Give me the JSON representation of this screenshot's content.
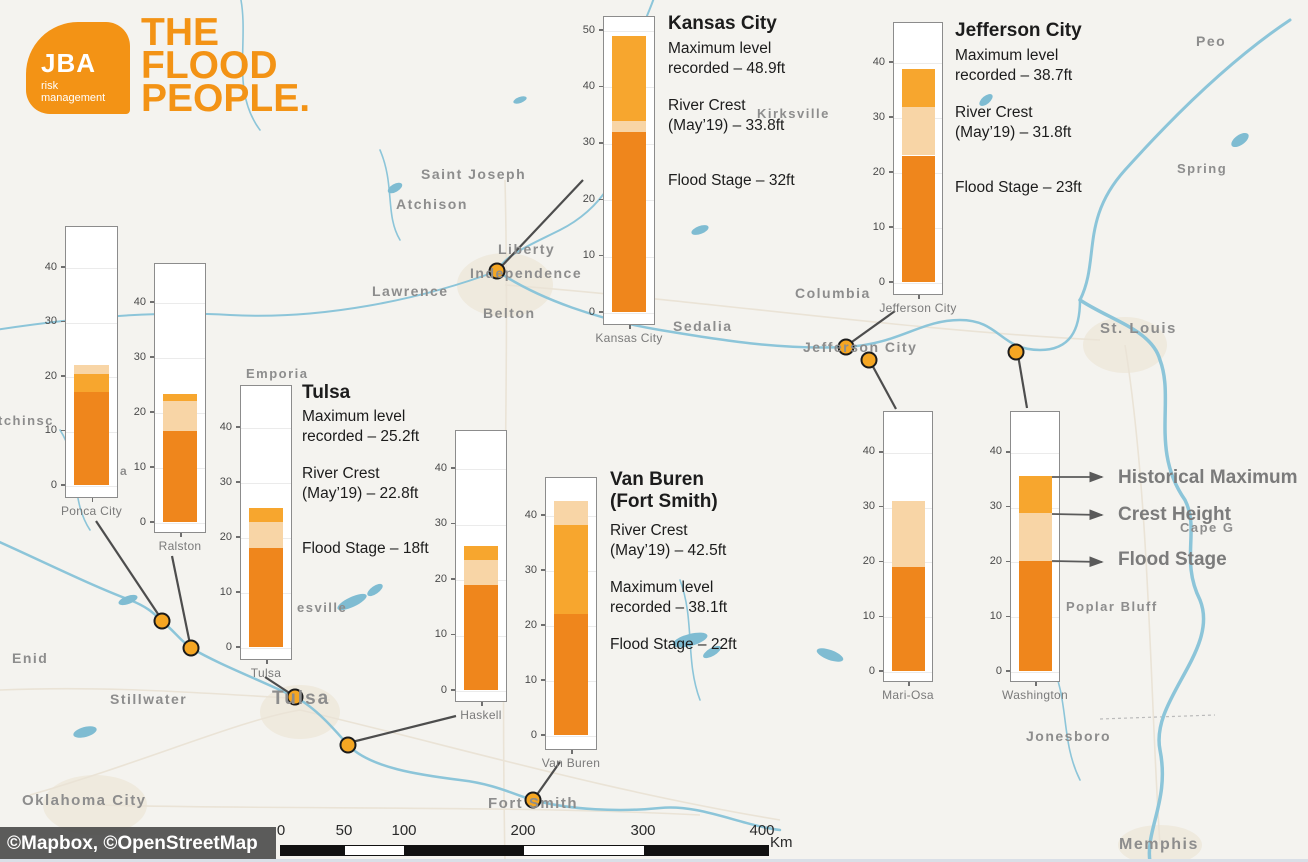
{
  "brand": {
    "logo_text": "JBA",
    "logo_sub_line1": "risk",
    "logo_sub_line2": "management",
    "tagline_line1": "THE",
    "tagline_line2": "FLOOD",
    "tagline_line3": "PEOPLE.",
    "orange": "#f39315"
  },
  "colors": {
    "flood_stage": "#ef861c",
    "crest": "#f8d5a6",
    "historical_maximum": "#f7a62e",
    "marker": "#f5a623",
    "map_label": "#8d8d8d",
    "legend_text": "#7b7b7b",
    "connector": "#4d4d4d",
    "water": "#8cc5d9"
  },
  "chart_data": [
    {
      "id": "kansas-city-gauge",
      "type": "bar",
      "gauge_label": "Kansas City",
      "yticks": [
        0,
        10,
        20,
        30,
        40,
        50
      ],
      "ylim": [
        0,
        52.5
      ],
      "values": {
        "flood_stage_ft": 32,
        "crest_may19_ft": 33.8,
        "historical_max_ft": 48.9
      },
      "segments": [
        {
          "role": "flood_stage",
          "from": 0,
          "to": 32
        },
        {
          "role": "crest",
          "from": 32,
          "to": 33.8
        },
        {
          "role": "historical_maximum",
          "from": 33.8,
          "to": 48.9
        }
      ]
    },
    {
      "id": "jefferson-city-gauge",
      "type": "bar",
      "gauge_label": "Jefferson City",
      "yticks": [
        0,
        10,
        20,
        30,
        40
      ],
      "ylim": [
        0,
        47.5
      ],
      "values": {
        "flood_stage_ft": 23,
        "crest_may19_ft": 31.8,
        "historical_max_ft": 38.7
      },
      "segments": [
        {
          "role": "flood_stage",
          "from": 0,
          "to": 23
        },
        {
          "role": "crest",
          "from": 23,
          "to": 31.8
        },
        {
          "role": "historical_maximum",
          "from": 31.8,
          "to": 38.7
        }
      ]
    },
    {
      "id": "ponca-city",
      "type": "bar",
      "gauge_label": "Ponca City",
      "yticks": [
        0,
        10,
        20,
        30,
        40
      ],
      "ylim": [
        0,
        47.5
      ],
      "values": {
        "flood_stage_ft": 17,
        "historical_max_ft": 20.3,
        "crest_may19_ft": 22
      },
      "segments": [
        {
          "role": "flood_stage",
          "from": 0,
          "to": 17
        },
        {
          "role": "historical_maximum",
          "from": 17,
          "to": 20.3
        },
        {
          "role": "crest",
          "from": 20.3,
          "to": 22
        }
      ]
    },
    {
      "id": "ralston",
      "type": "bar",
      "gauge_label": "Ralston",
      "yticks": [
        0,
        10,
        20,
        30,
        40
      ],
      "ylim": [
        0,
        47.5
      ],
      "values": {
        "flood_stage_ft": 16.5,
        "crest_may19_ft": 22,
        "historical_max_ft": 23.3
      },
      "segments": [
        {
          "role": "flood_stage",
          "from": 0,
          "to": 16.5
        },
        {
          "role": "crest",
          "from": 16.5,
          "to": 22
        },
        {
          "role": "historical_maximum",
          "from": 22,
          "to": 23.3
        }
      ]
    },
    {
      "id": "tulsa-gauge",
      "type": "bar",
      "gauge_label": "Tulsa",
      "yticks": [
        0,
        10,
        20,
        30,
        40
      ],
      "ylim": [
        0,
        47.5
      ],
      "values": {
        "flood_stage_ft": 18,
        "crest_may19_ft": 22.8,
        "historical_max_ft": 25.2
      },
      "segments": [
        {
          "role": "flood_stage",
          "from": 0,
          "to": 18
        },
        {
          "role": "crest",
          "from": 18,
          "to": 22.8
        },
        {
          "role": "historical_maximum",
          "from": 22.8,
          "to": 25.2
        }
      ]
    },
    {
      "id": "haskell",
      "type": "bar",
      "gauge_label": "Haskell",
      "yticks": [
        0,
        10,
        20,
        30,
        40
      ],
      "ylim": [
        0,
        47.5
      ],
      "values": {
        "flood_stage_ft": 19,
        "crest_may19_ft": 23.5,
        "historical_max_ft": 26
      },
      "segments": [
        {
          "role": "flood_stage",
          "from": 0,
          "to": 19
        },
        {
          "role": "crest",
          "from": 19,
          "to": 23.5
        },
        {
          "role": "historical_maximum",
          "from": 23.5,
          "to": 26
        }
      ]
    },
    {
      "id": "van-buren",
      "type": "bar",
      "gauge_label": "Van Buren",
      "yticks": [
        0,
        10,
        20,
        30,
        40
      ],
      "ylim": [
        0,
        46.9
      ],
      "values": {
        "flood_stage_ft": 22,
        "historical_max_ft": 38.1,
        "crest_may19_ft": 42.5
      },
      "segments": [
        {
          "role": "flood_stage",
          "from": 0,
          "to": 22
        },
        {
          "role": "historical_maximum",
          "from": 22,
          "to": 38.1
        },
        {
          "role": "crest",
          "from": 38.1,
          "to": 42.5
        }
      ]
    },
    {
      "id": "mari-osa",
      "type": "bar",
      "gauge_label": "Mari-Osa",
      "yticks": [
        0,
        10,
        20,
        30,
        40
      ],
      "ylim": [
        0,
        47.5
      ],
      "values": {
        "flood_stage_ft": 19,
        "crest_may19_ft": 31
      },
      "segments": [
        {
          "role": "flood_stage",
          "from": 0,
          "to": 19
        },
        {
          "role": "crest",
          "from": 19,
          "to": 31
        }
      ]
    },
    {
      "id": "washington",
      "type": "bar",
      "gauge_label": "Washington",
      "yticks": [
        0,
        10,
        20,
        30,
        40
      ],
      "ylim": [
        0,
        47.5
      ],
      "values": {
        "flood_stage_ft": 20,
        "crest_may19_ft": 28.8,
        "historical_max_ft": 35.5
      },
      "segments": [
        {
          "role": "flood_stage",
          "from": 0,
          "to": 20
        },
        {
          "role": "crest",
          "from": 20,
          "to": 28.8
        },
        {
          "role": "historical_maximum",
          "from": 28.8,
          "to": 35.5
        }
      ]
    }
  ],
  "callouts": [
    {
      "id": "kansas-city",
      "title_lines": [
        "Kansas City"
      ],
      "paragraphs": [
        [
          "Maximum level",
          "recorded – 48.9ft"
        ],
        [
          "River Crest",
          "(May’19) – 33.8ft"
        ],
        [
          "Flood Stage – 32ft"
        ]
      ]
    },
    {
      "id": "jefferson-city",
      "title_lines": [
        "Jefferson City"
      ],
      "paragraphs": [
        [
          "Maximum level",
          "recorded – 38.7ft"
        ],
        [
          "River Crest",
          "(May’19) – 31.8ft"
        ],
        [
          "Flood Stage – 23ft"
        ]
      ]
    },
    {
      "id": "tulsa",
      "title_lines": [
        "Tulsa"
      ],
      "paragraphs": [
        [
          "Maximum level",
          "recorded – 25.2ft"
        ],
        [
          "River Crest",
          "(May’19) – 22.8ft"
        ],
        [
          "Flood Stage – 18ft"
        ]
      ]
    },
    {
      "id": "van-buren",
      "title_lines": [
        "Van Buren",
        "(Fort Smith)"
      ],
      "paragraphs": [
        [
          "River Crest",
          "(May’19) – 42.5ft"
        ],
        [
          "Maximum level",
          "recorded – 38.1ft"
        ],
        [
          "Flood Stage – 22ft"
        ]
      ]
    }
  ],
  "legend": {
    "items": [
      "Historical Maximum",
      "Crest Height",
      "Flood Stage"
    ]
  },
  "map_labels": [
    {
      "text": "Saint Joseph",
      "x": 421,
      "y": 166,
      "fs": 14
    },
    {
      "text": "Atchison",
      "x": 396,
      "y": 196,
      "fs": 14
    },
    {
      "text": "Liberty",
      "x": 498,
      "y": 241,
      "fs": 14
    },
    {
      "text": "Independence",
      "x": 470,
      "y": 265,
      "fs": 14
    },
    {
      "text": "Lawrence",
      "x": 372,
      "y": 283,
      "fs": 14
    },
    {
      "text": "Belton",
      "x": 483,
      "y": 305,
      "fs": 14
    },
    {
      "text": "Kirksville",
      "x": 757,
      "y": 106,
      "fs": 13
    },
    {
      "text": "Sedalia",
      "x": 673,
      "y": 318,
      "fs": 14
    },
    {
      "text": "Columbia",
      "x": 795,
      "y": 285,
      "fs": 14
    },
    {
      "text": "Jefferson City",
      "x": 803,
      "y": 339,
      "fs": 14
    },
    {
      "text": "St. Louis",
      "x": 1100,
      "y": 320,
      "fs": 15
    },
    {
      "text": "Peo",
      "x": 1196,
      "y": 33,
      "fs": 14
    },
    {
      "text": "Spring",
      "x": 1177,
      "y": 161,
      "fs": 13
    },
    {
      "text": "tchinsc",
      "x": -2,
      "y": 413,
      "fs": 13
    },
    {
      "text": "Emporia",
      "x": 246,
      "y": 366,
      "fs": 13
    },
    {
      "text": "esville",
      "x": 297,
      "y": 600,
      "fs": 13
    },
    {
      "text": "a",
      "x": 120,
      "y": 464,
      "fs": 12
    },
    {
      "text": "Enid",
      "x": 12,
      "y": 650,
      "fs": 14
    },
    {
      "text": "Stillwater",
      "x": 110,
      "y": 691,
      "fs": 14
    },
    {
      "text": "Tulsa",
      "x": 272,
      "y": 688,
      "fs": 19
    },
    {
      "text": "Oklahoma City",
      "x": 22,
      "y": 792,
      "fs": 15
    },
    {
      "text": "Fort Smith",
      "x": 488,
      "y": 795,
      "fs": 15
    },
    {
      "text": "Jonesboro",
      "x": 1026,
      "y": 728,
      "fs": 14
    },
    {
      "text": "Poplar Bluff",
      "x": 1066,
      "y": 599,
      "fs": 13
    },
    {
      "text": "Cape G",
      "x": 1180,
      "y": 520,
      "fs": 13
    },
    {
      "text": "Memphis",
      "x": 1119,
      "y": 836,
      "fs": 16
    }
  ],
  "markers": [
    {
      "id": "independence",
      "x": 497,
      "y": 271
    },
    {
      "id": "jefferson-city",
      "x": 846,
      "y": 347
    },
    {
      "id": "mari-osa",
      "x": 869,
      "y": 360
    },
    {
      "id": "washington",
      "x": 1016,
      "y": 352
    },
    {
      "id": "ponca-city",
      "x": 162,
      "y": 621
    },
    {
      "id": "ralston",
      "x": 191,
      "y": 648
    },
    {
      "id": "tulsa",
      "x": 295,
      "y": 697
    },
    {
      "id": "haskell",
      "x": 348,
      "y": 745
    },
    {
      "id": "van-buren",
      "x": 533,
      "y": 800
    }
  ],
  "scale_bar": {
    "ticks": [
      "0",
      "50",
      "100",
      "200",
      "300",
      "400"
    ],
    "unit": "Km"
  },
  "attribution": "©Mapbox, ©OpenStreetMap"
}
